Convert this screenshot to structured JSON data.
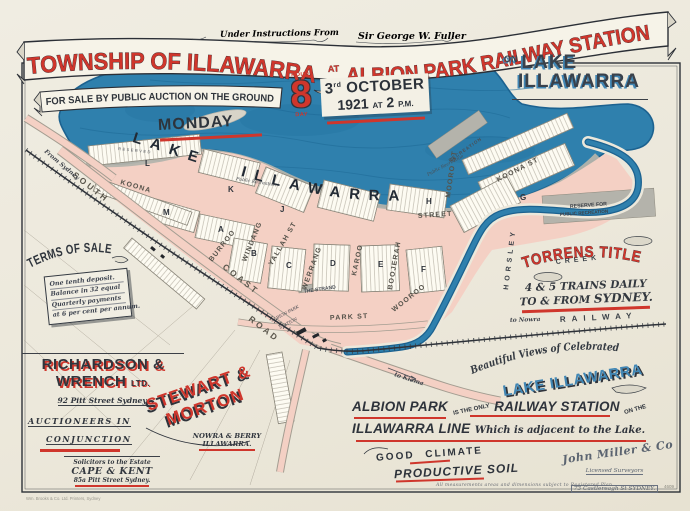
{
  "colors": {
    "red": "#cf362c",
    "ink": "#30353d",
    "lake_blue": "#2f80ad",
    "lake_dark": "#1c6290",
    "street_pink": "#f4d0c4",
    "reserve_gray": "#b4b3ab",
    "paper": "#ece8db",
    "blue_text": "#4186b4"
  },
  "header": {
    "instructions_prefix": "Under Instructions From",
    "instructions_name": "Sir George W. Fuller",
    "title_left": "TOWNSHIP OF ILLAWARRA",
    "title_at": "AT",
    "title_right": "ALBION PARK RAILWAY STATION",
    "sale_ribbon": "FOR SALE BY PUBLIC AUCTION ON THE GROUND",
    "monday": "MONDAY",
    "eight": "8",
    "eight_top": "HOUR",
    "eight_bottom": "DAY",
    "date_day": "3",
    "date_ord": "rd",
    "date_month": "OCTOBER",
    "date_year": "1921",
    "date_at": "AT",
    "date_time": "2",
    "date_pm": "P.M.",
    "on_word": "ON",
    "lake_word": "LAKE",
    "illawarra_word": "ILLAWARRA"
  },
  "map": {
    "lake_label": "LAKE ILLAWARRA",
    "creek_name": "HORSLEY",
    "creek_word": "CREEK",
    "railway": "RAILWAY",
    "station_line1": "ALBION PARK",
    "station_line2": "STATION",
    "streets": [
      "SOUTH",
      "COAST",
      "ROAD",
      "KOONA",
      "KOONA ST",
      "BURROO",
      "WINDANG",
      "YALLAH ST",
      "WERRANG",
      "KAROO",
      "BOOJERAH",
      "WOOROO",
      "MOORO ST",
      "STREET",
      "PARK ST",
      "THE STRAND"
    ],
    "sections": [
      "A",
      "B",
      "C",
      "D",
      "E",
      "F",
      "G",
      "H",
      "J",
      "K",
      "L",
      "M"
    ],
    "reserves": {
      "public_recreation": "Public Recreation",
      "reserve_line1": "RESERVE FOR",
      "reserve_line2": "PUBLIC RECREATION",
      "recreation": "RECREATION",
      "reserved": "RESERVED"
    },
    "directions": {
      "from_sydney": "From Sydney",
      "to_nowra": "to Nowra",
      "to_kiama": "to Kiama"
    }
  },
  "terms": {
    "heading": "TERMS OF SALE",
    "line1": "One tenth deposit.",
    "line2": "Balance in 32 equal",
    "line3": "Quarterly payments",
    "line4": "at 6 per cent per annum."
  },
  "agents": {
    "rw_line1": "RICHARDSON &",
    "rw_line2": "WRENCH",
    "rw_ltd": "LTD.",
    "rw_address": "92 Pitt Street Sydney.",
    "rw_role1": "AUCTIONEERS IN",
    "rw_role2": "CONJUNCTION",
    "sm_line1": "STEWART &",
    "sm_line2": "MORTON",
    "sm_sub1": "NOWRA & BERRY",
    "sm_sub2": "ILLAWARRA."
  },
  "solicitors": {
    "intro": "Solicitors to the Estate",
    "name": "CAPE & KENT",
    "address": "85a Pitt Street Sydney."
  },
  "claims": {
    "torrens": "TORRENS TITLE",
    "trains1": "4 & 5 TRAINS DAILY",
    "trains2": "TO & FROM",
    "trains2b": "SYDNEY.",
    "views": "Beautiful Views of Celebrated",
    "views_lake": "LAKE ILLAWARRA",
    "ap1": "ALBION PARK",
    "ap2": "IS THE ONLY",
    "ap3": "RAILWAY STATION",
    "ap4": "ON THE",
    "ap5": "ILLAWARRA LINE",
    "ap6": "Which is adjacent to the Lake.",
    "climate": "GOOD CLIMATE",
    "soil": "PRODUCTIVE SOIL"
  },
  "surveyor": {
    "signature": "John Miller & Co",
    "role": "Licensed Surveyors",
    "address": "73 Castlereagh St SYDNEY."
  },
  "footer": {
    "fine_print": "All measurements areas and dimensions subject to Registered Plan.",
    "imprint": "Wm. Brooks & Co. Ltd. Printers, Sydney",
    "plan_number": "4609"
  }
}
